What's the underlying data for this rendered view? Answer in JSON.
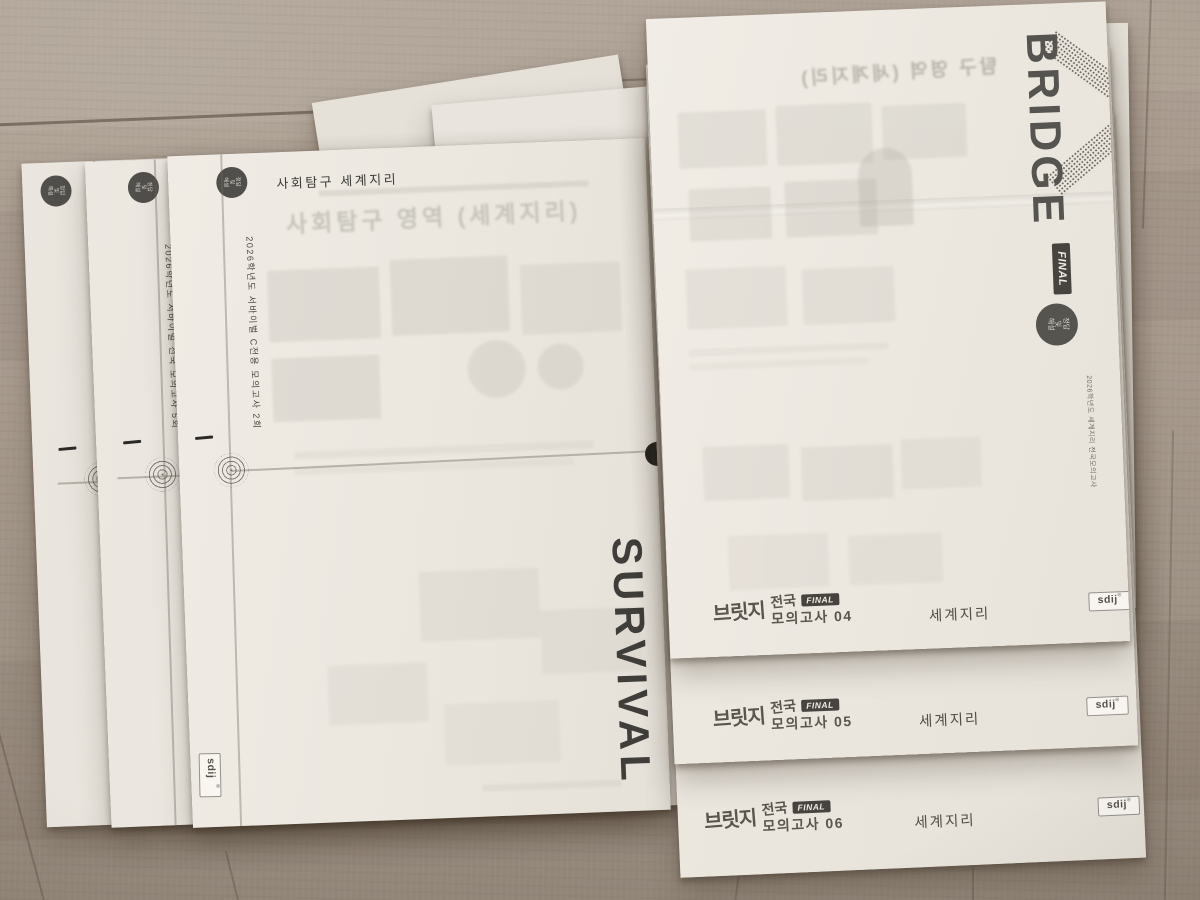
{
  "answer_badge": {
    "line1": "정답",
    "line2": "및",
    "line3": "해설"
  },
  "left_stack": {
    "header": "사회탐구 세계지리",
    "header_partial": "사",
    "ghost_title": "사회탐구 영역 (세계지리)",
    "side_title": "SURVIVAL",
    "publisher": "sdij",
    "publisher_mark": "®",
    "sheets": [
      {
        "spine_label": "2026학년도 서바이벌 전국 모의고사 6회"
      },
      {
        "spine_label": "2026학년도 서바이벌 전국 모의고사 5회"
      },
      {
        "spine_label": "2026학년도 서바이벌 C전용 모의고사 2회"
      }
    ]
  },
  "right_stack": {
    "brand": "BRIDGE",
    "final_label": "FINAL",
    "spine_label": "2026학년도 세계지리 전국모의고사",
    "ghost_title": "탐구 영역 (세계지리)",
    "series_kr": "브릿지",
    "region": "전국",
    "subject": "세계지리",
    "publisher": "sdij",
    "publisher_mark": "®",
    "sheets": [
      {
        "exam_title": "모의고사 04"
      },
      {
        "exam_title": "모의고사 05"
      },
      {
        "exam_title": "모의고사 06"
      }
    ]
  },
  "colors": {
    "floor": "#a59889",
    "paper": "#eee9e2",
    "badge_dark": "#514f4b",
    "ink_dark": "#403e3b"
  }
}
